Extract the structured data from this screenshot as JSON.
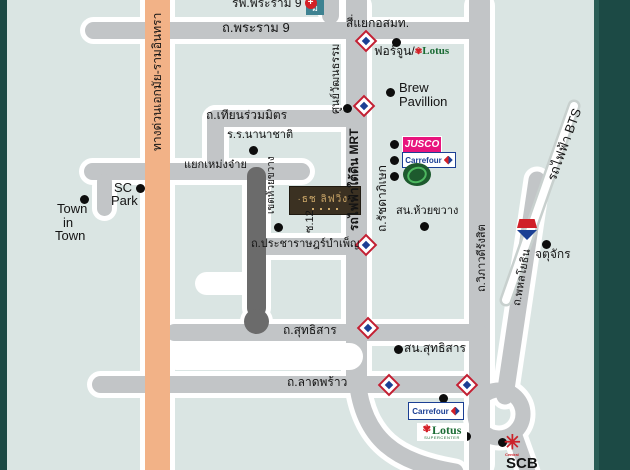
{
  "title": "แผนที่ที่ตั้งโครงการ ย่านรัชดาภิเษก-ห้วยขวาง",
  "colors": {
    "background": "#dae5e3",
    "border_teal": "#1c4a45",
    "road_gray": "#c2c5c7",
    "road_dark_soi": "#6b6b6b",
    "expressway_orange": "#f2b287",
    "jusco_pink": "#e8147d",
    "carrefour_blue": "#1b3f94",
    "lotus_green": "#1a6b34",
    "lotus_red": "#d42027",
    "mrt_red": "#c22033",
    "bts_red": "#d02028",
    "bts_navy": "#1b3f94",
    "central_red": "#cc2229",
    "project_box_brown": "#3b3122",
    "project_gold": "#cda869",
    "station_teal": "#3e8291"
  },
  "roads": {
    "rama9": "ถ.พระราม 9",
    "mcot_intersection": "สี่แยกอสมท.",
    "thiam_ruam_mit": "ถ.เทียนร่วมมิตร",
    "meng_jai": "แยกเหม่งจ๋าย",
    "pracharat_bamphen": "ถ.ประชาราษฎร์บำเพ็ญ",
    "sutthisan": "ถ.สุทธิสาร",
    "lat_phrao": "ถ.ลาดพร้าว",
    "ratchadaphisek": "ถ.รัชดาภิเษก",
    "mrt_line": "รถไฟฟ้าใต้ดิน MRT",
    "expressway": "ทางด่วนเอกมัย-รามอินทรา",
    "vibhavadi": "ถ.วิภาวดีรังสิต",
    "phahonyothin": "ถ.พหลโยธิน",
    "bts_line": "รถไฟฟ้า BTS",
    "soi12": "ซ.12"
  },
  "places": {
    "rama9_hospital": "รพ.พระราม 9",
    "fortune": "ฟอร์จูน/",
    "brew1": "Brew",
    "brew2": "Pavillion",
    "cultural_centre": "ศูนย์วัฒนธรรม",
    "huai_khwang_police": "สน.ห้วยขวาง",
    "huai_khwang_district": "เขตห้วยขวาง",
    "school": "ร.ร.นานาชาติ",
    "sc1": "SC",
    "sc2": "Park",
    "town1": "Town",
    "town2": "in",
    "town3": "Town",
    "sutthisan_police": "สน.สุทธิสาร",
    "chatuchak": "จตุจักร",
    "scb": "SCB",
    "project": "·ธช ลิฟวิ่ง·"
  },
  "logos": {
    "jusco": "JUSCO",
    "carrefour": "Carrefour",
    "lotus": "Lotus",
    "lotus_sub": "SUPERCENTER",
    "central": "Central",
    "station_box": "ม"
  },
  "icons": {
    "hospital_cross": "+",
    "central_flower": "✳",
    "lotus_flower": "✾"
  }
}
